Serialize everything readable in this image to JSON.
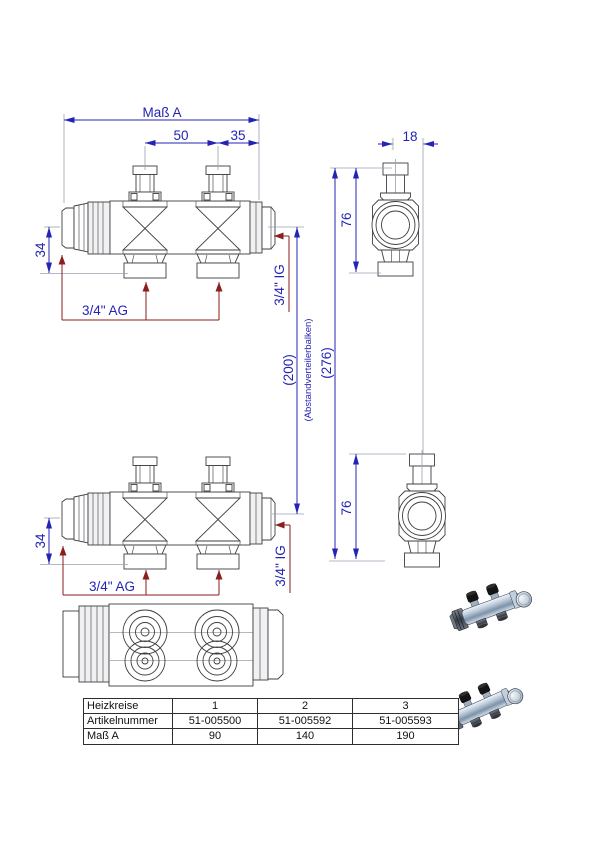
{
  "colors": {
    "dimension_blue": "#2424b4",
    "leader_red": "#8b1e1e",
    "outline_gray": "#3f3f3f"
  },
  "views": {
    "front_top": {
      "dim_mass_a": "Maß A",
      "dim_50": "50",
      "dim_35": "35",
      "dim_34": "34",
      "label_ag": "3/4\" AG",
      "label_ig": "3/4\" IG"
    },
    "front_middle": {
      "dim_34": "34",
      "label_ag": "3/4\" AG",
      "label_ig": "3/4\" IG"
    },
    "side": {
      "dim_18": "18",
      "dim_76_upper": "76",
      "dim_76_lower": "76",
      "dim_276": "(276)",
      "dim_200": "(200)",
      "label_spacer": "(Abstandverteilerbalken)"
    }
  },
  "table": {
    "rows": [
      {
        "label": "Heizkreise",
        "values": [
          "1",
          "2",
          "3"
        ]
      },
      {
        "label": "Artikelnummer",
        "values": [
          "51-005500",
          "51-005592",
          "51-005593"
        ]
      },
      {
        "label": "Maß A",
        "values": [
          "90",
          "140",
          "190"
        ]
      }
    ]
  }
}
